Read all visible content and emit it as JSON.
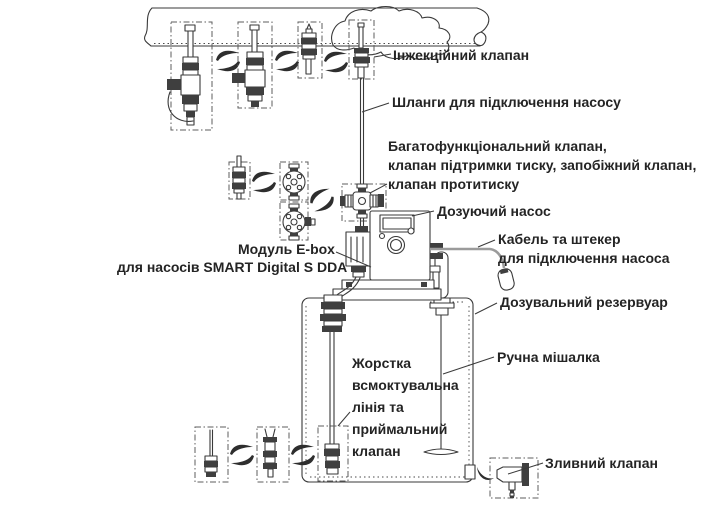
{
  "diagram": {
    "title_hint": "Dosing pump installation diagram",
    "labels": {
      "injection_valve": "Інжекційний клапан",
      "hoses": "Шланги для підключення насосу",
      "multifunction_valve": "Багатофункціональний клапан,\nклапан підтримки тиску, запобіжний клапан,\nклапан протитиску",
      "dosing_pump": "Дозуючий насос",
      "cable_plug": "Кабель та штекер\nдля підключення насоса",
      "ebox_line1": "Модуль E-box",
      "ebox_line2": "для насосів SMART Digital S DDA",
      "tank": "Дозувальний резервуар",
      "mixer": "Ручна мішалка",
      "suction_line": "Жорстка\nвсмоктувальна\nлінія та\nприймальний\nклапан",
      "drain_valve": "Зливний клапан"
    },
    "colors": {
      "line": "#3a3a3a",
      "text": "#242424",
      "cable": "#9b9b9b",
      "background": "#ffffff"
    }
  }
}
